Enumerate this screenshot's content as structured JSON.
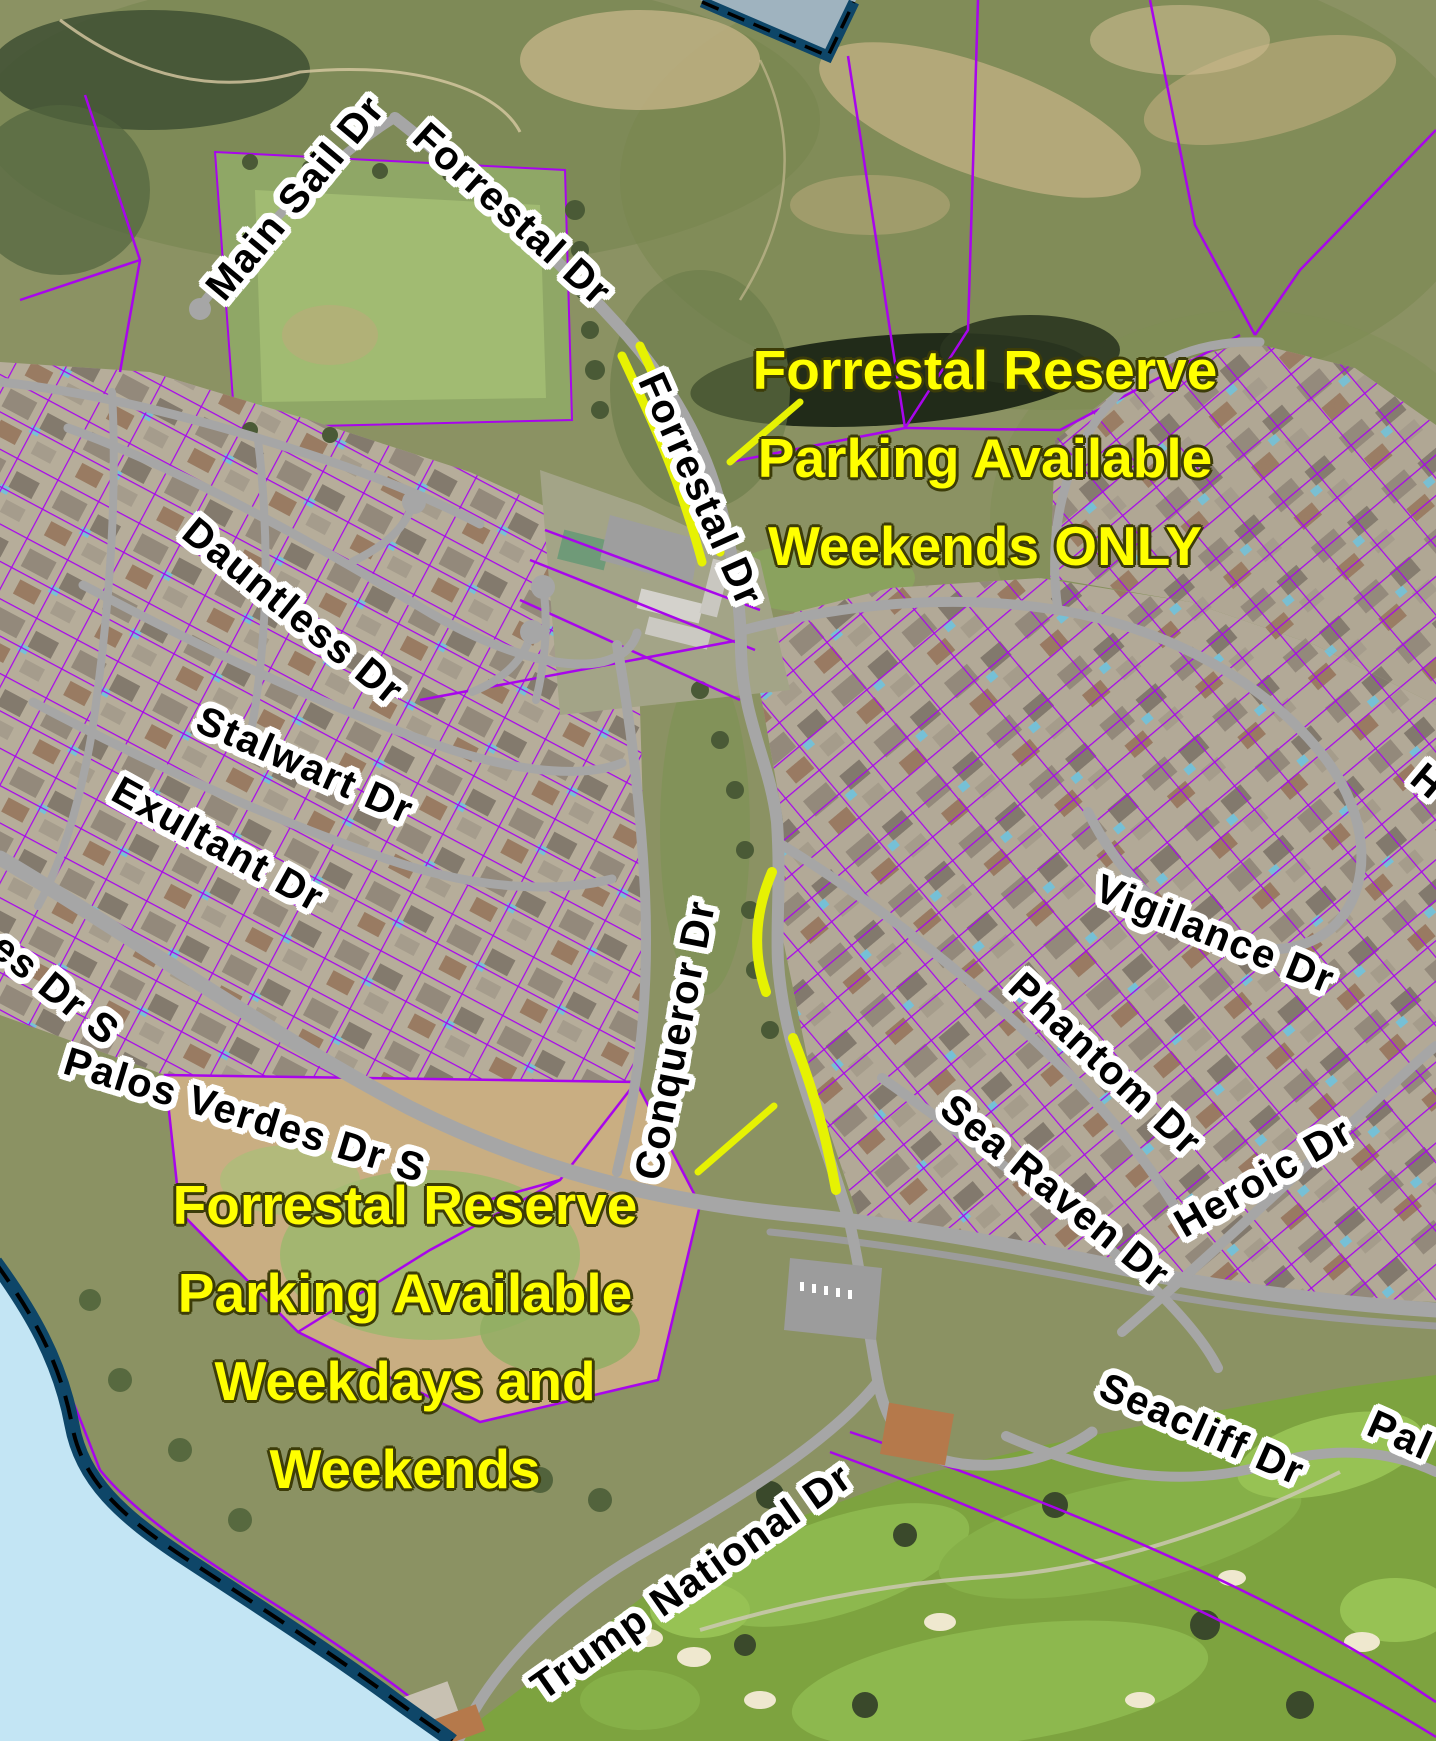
{
  "map": {
    "title": "Forrestal Reserve parking map",
    "street_labels": [
      {
        "id": "main-sail-dr",
        "text": "Main Sail Dr"
      },
      {
        "id": "forrestal-dr-upper",
        "text": "Forrestal Dr"
      },
      {
        "id": "forrestal-dr-lower",
        "text": "Forrestal Dr"
      },
      {
        "id": "dauntless-dr",
        "text": "Dauntless Dr"
      },
      {
        "id": "stalwart-dr",
        "text": "Stalwart Dr"
      },
      {
        "id": "exultant-dr",
        "text": "Exultant Dr"
      },
      {
        "id": "palos-verdes-dr-s-partial",
        "text": "es Dr S"
      },
      {
        "id": "palos-verdes-dr-s",
        "text": "Palos Verdes Dr S"
      },
      {
        "id": "conqueror-dr",
        "text": "Conqueror Dr"
      },
      {
        "id": "vigilance-dr",
        "text": "Vigilance Dr"
      },
      {
        "id": "phantom-dr",
        "text": "Phantom Dr"
      },
      {
        "id": "sea-raven-dr",
        "text": "Sea Raven Dr"
      },
      {
        "id": "heroic-dr",
        "text": "Heroic Dr"
      },
      {
        "id": "seacliff-dr",
        "text": "Seacliff Dr"
      },
      {
        "id": "palos-edge-partial",
        "text": "Pal"
      },
      {
        "id": "trump-national-dr",
        "text": "Trump National Dr"
      },
      {
        "id": "h-edge-partial",
        "text": "H"
      }
    ],
    "annotations": [
      {
        "id": "weekends-only",
        "lines": [
          "Forrestal Reserve",
          "Parking Available",
          "Weekends ONLY"
        ]
      },
      {
        "id": "weekdays-and-weekends",
        "lines": [
          "Forrestal Reserve",
          "Parking Available",
          "Weekdays and",
          "Weekends"
        ]
      }
    ],
    "colors": {
      "annotation_yellow": "#FFFF00",
      "road_highlight_yellow": "#E6F203",
      "parcel_purple": "#A805EC",
      "road_gray": "#A6A6A6",
      "ocean_blue": "#C3E5F4",
      "coast_boundary_navy": "#0E4668",
      "street_label_text": "#000000",
      "street_label_halo": "#FFFFFF"
    }
  }
}
